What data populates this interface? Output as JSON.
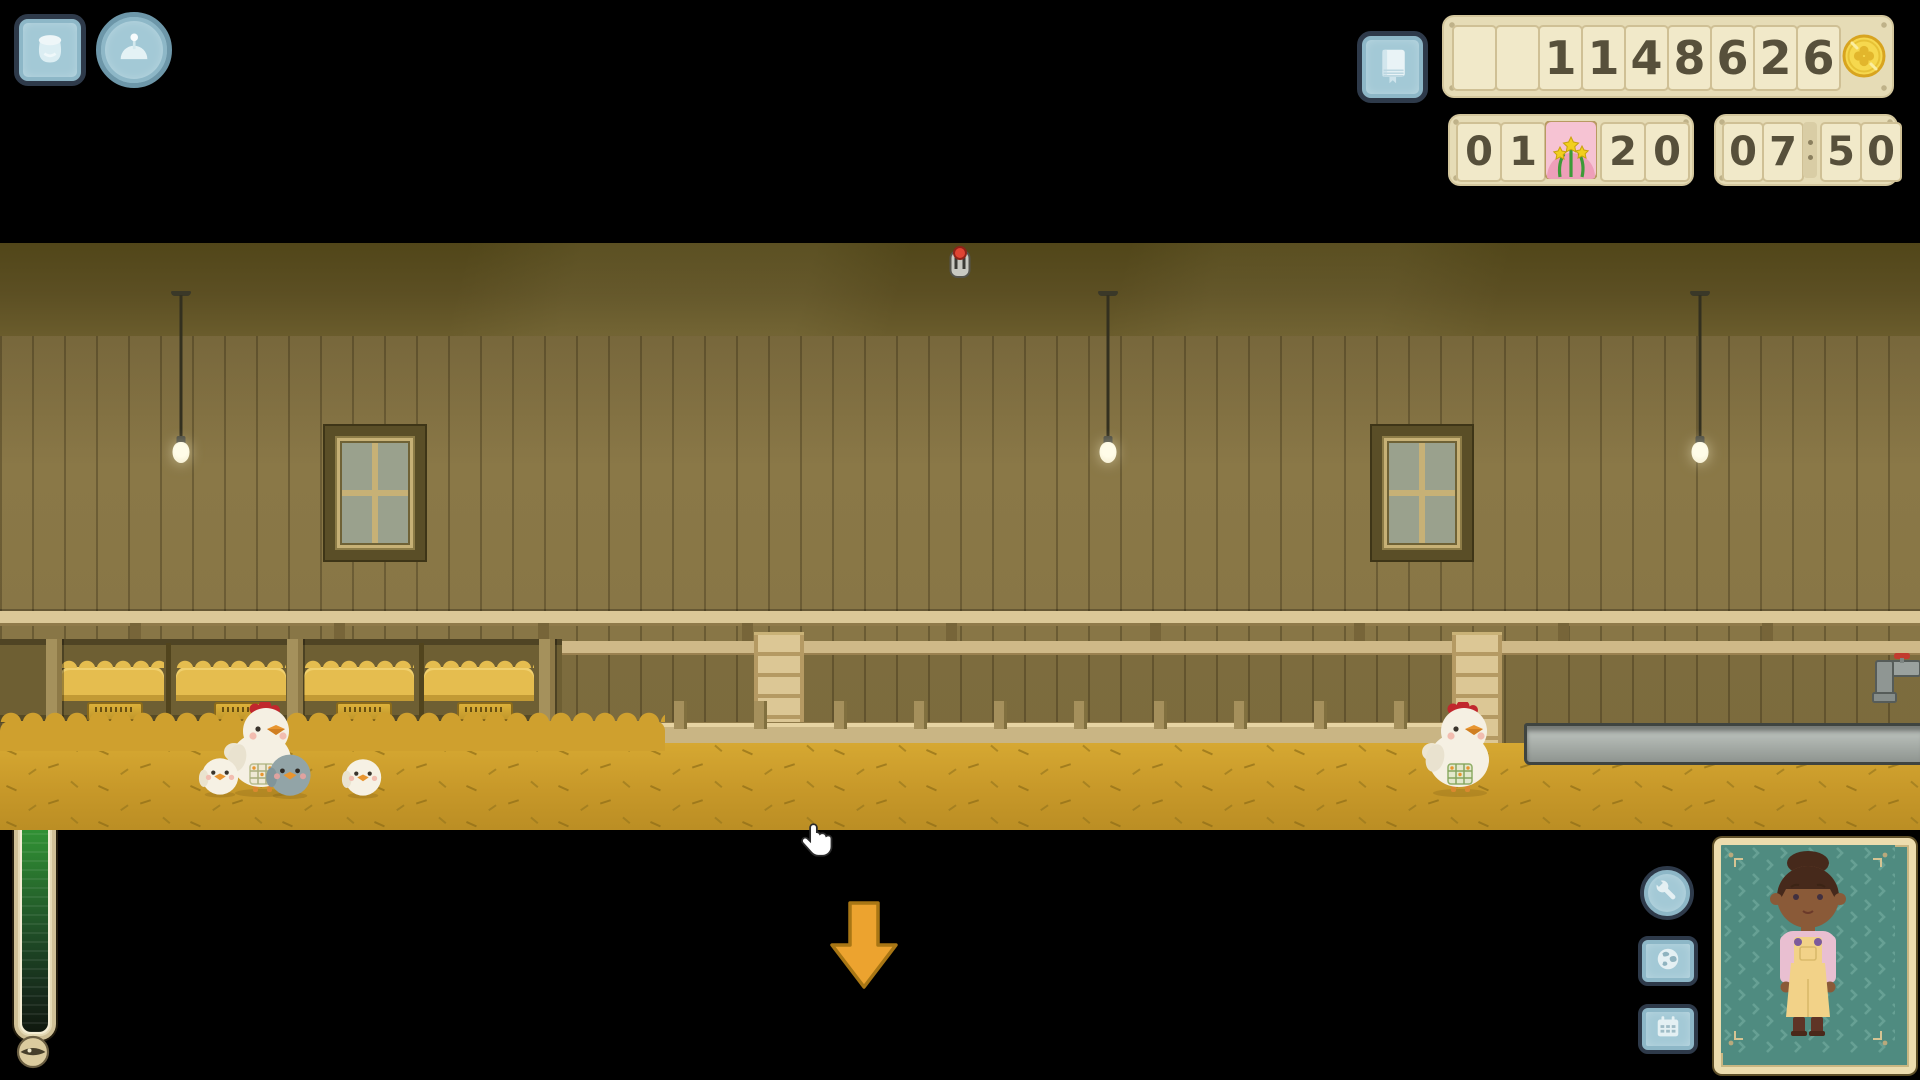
{
  "hud": {
    "top_left": {
      "feed_button_icon": "feed-bag-icon",
      "brooder_button_icon": "heat-lamp-icon"
    },
    "top_right": {
      "journal_button_icon": "journal-book-icon",
      "money": {
        "value": "1148626",
        "cells": [
          "",
          "",
          "1",
          "1",
          "4",
          "8",
          "6",
          "2",
          "6"
        ],
        "currency_icon": "clover-coin-icon"
      },
      "date": {
        "value": "01 20",
        "cells_left": [
          "0",
          "1"
        ],
        "season_icon": "daffodil-flower-icon",
        "cells_right": [
          "2",
          "0"
        ]
      },
      "time": {
        "value": "07:50",
        "cells_left": [
          "0",
          "7"
        ],
        "separator": ":",
        "cells_right": [
          "5",
          "0"
        ]
      }
    },
    "left_meter": {
      "top_icon": "moon-icon",
      "bottom_icon": "closed-eye-icon",
      "fill_percent": 86,
      "fill_color": "#3cb83a"
    },
    "bottom_right": {
      "buttons": [
        "wrench-icon",
        "globe-icon",
        "calendar-icon"
      ],
      "portrait_subject": "farmer-girl"
    }
  },
  "scene": {
    "name": "chicken-coop-interior",
    "nest_nameplate_count": 4,
    "entities": [
      {
        "type": "hen",
        "variant": "white-apron-mother"
      },
      {
        "type": "chick",
        "variant": "white"
      },
      {
        "type": "chick",
        "variant": "grey"
      },
      {
        "type": "chick",
        "variant": "white"
      },
      {
        "type": "hen",
        "variant": "white-apron"
      }
    ],
    "fixtures": [
      "hanging-lamp",
      "hanging-lamp",
      "hanging-lamp",
      "window",
      "window",
      "red-lever",
      "ladder",
      "ladder",
      "nest-boxes",
      "water-trough",
      "faucet"
    ]
  },
  "nav": {
    "down_arrow_icon": "down-arrow-icon"
  },
  "colors": {
    "panel_bg": "#e6dcb6",
    "digit_color": "#57503b",
    "button_blue": "#a3c9d6",
    "meter_green": "#3cb83a",
    "floor": "#c79829",
    "wall": "#8a7847",
    "arrow_orange": "#eca32f",
    "portrait_teal": "#4f8b80",
    "coin_gold": "#f6d84e"
  },
  "cursor": "hand-pointer"
}
